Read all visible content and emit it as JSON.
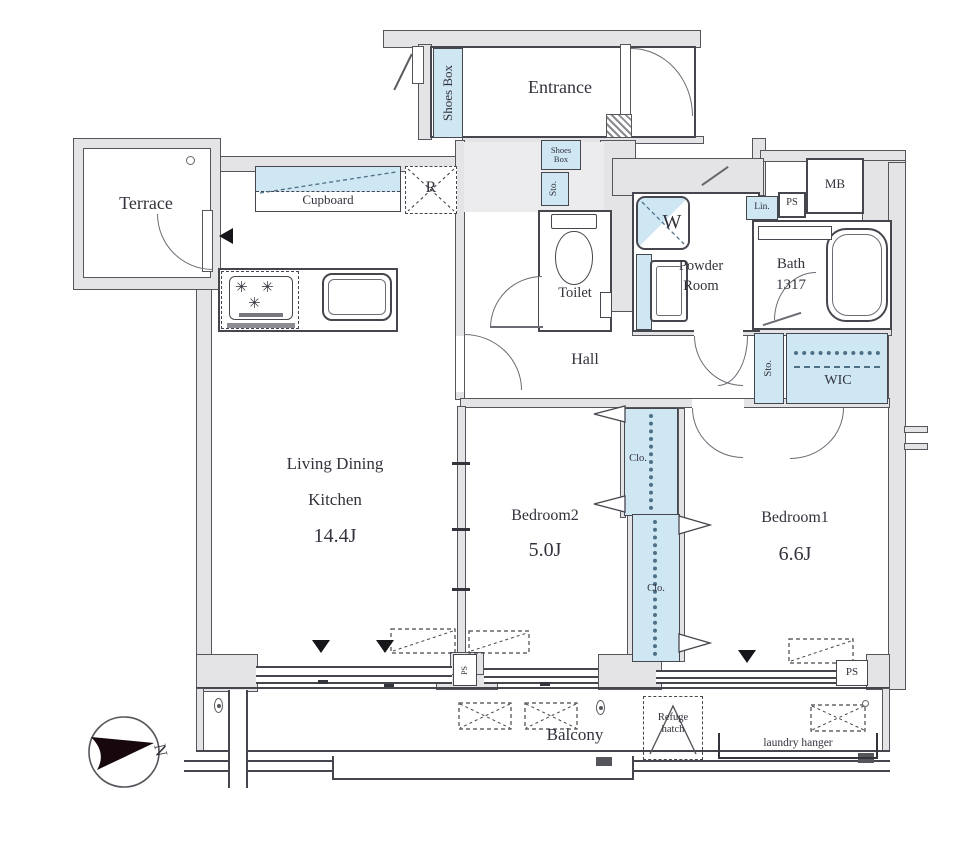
{
  "rooms": {
    "entrance": "Entrance",
    "terrace": "Terrace",
    "toilet": "Toilet",
    "powder_room": {
      "line1": "Powder",
      "line2": "Room"
    },
    "bath": {
      "line1": "Bath",
      "line2": "1317"
    },
    "hall": "Hall",
    "ldk": {
      "line1": "Living Dining",
      "line2": "Kitchen",
      "area": "14.4J"
    },
    "bedroom2": {
      "label": "Bedroom2",
      "area": "5.0J"
    },
    "bedroom1": {
      "label": "Bedroom1",
      "area": "6.6J"
    },
    "wic": "WIC",
    "balcony": "Balcony"
  },
  "fixtures": {
    "shoes_box": "Shoes Box",
    "storage": "Sto.",
    "linen": "Lin.",
    "pipe_space": "PS",
    "meter_box": "MB",
    "washer": "W",
    "refrigerator": "R",
    "closet": "Clo.",
    "cupboard": "Cupboard",
    "refuge_hatch": {
      "line1": "Refuge",
      "line2": "hatch"
    },
    "laundry_hanger": "laundry hanger",
    "burner_symbol": "✳"
  },
  "compass": {
    "north": "N"
  },
  "colors": {
    "fixture_blue": "#cfe6f3",
    "wall_gray": "#e4e4e7",
    "line": "#46464e",
    "text": "#32323c"
  }
}
